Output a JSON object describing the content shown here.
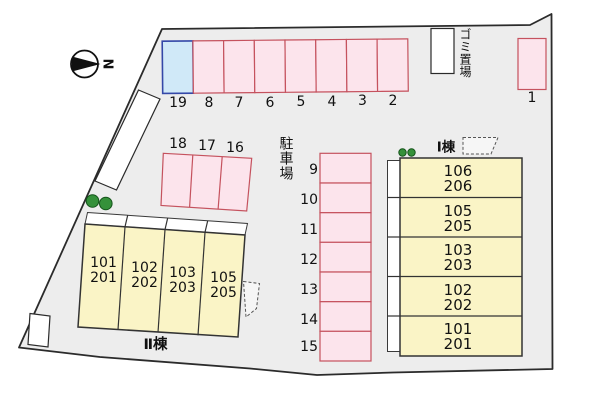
{
  "north_label": "N",
  "labels": {
    "parking_lot": "駐車場",
    "garbage": "ゴミ置場",
    "building_1": "Ⅰ棟",
    "building_2": "Ⅱ棟"
  },
  "parking": {
    "top_row": [
      "19",
      "8",
      "7",
      "6",
      "5",
      "4",
      "3",
      "2"
    ],
    "space_1": "1",
    "left_block": [
      "18",
      "17",
      "16"
    ],
    "middle_column": [
      "9",
      "10",
      "11",
      "12",
      "13",
      "14",
      "15"
    ]
  },
  "building_1": {
    "units": [
      {
        "upper": "106",
        "lower": "206"
      },
      {
        "upper": "105",
        "lower": "205"
      },
      {
        "upper": "103",
        "lower": "203"
      },
      {
        "upper": "102",
        "lower": "202"
      },
      {
        "upper": "101",
        "lower": "201"
      }
    ]
  },
  "building_2": {
    "units": [
      {
        "upper": "101",
        "lower": "201"
      },
      {
        "upper": "102",
        "lower": "202"
      },
      {
        "upper": "103",
        "lower": "203"
      },
      {
        "upper": "105",
        "lower": "205"
      }
    ]
  },
  "colors": {
    "site_fill": "#ededed",
    "boundary": "#2b2b2b",
    "parking_fill": "#fce4ec",
    "parking_stroke": "#c5525e",
    "space19_fill": "#d0e9f8",
    "space19_stroke": "#3448a8",
    "building_fill": "#faf4c6",
    "building_stroke": "#333333",
    "tree_fill": "#35913a",
    "tree_stroke": "#14541a",
    "text": "#111111"
  }
}
